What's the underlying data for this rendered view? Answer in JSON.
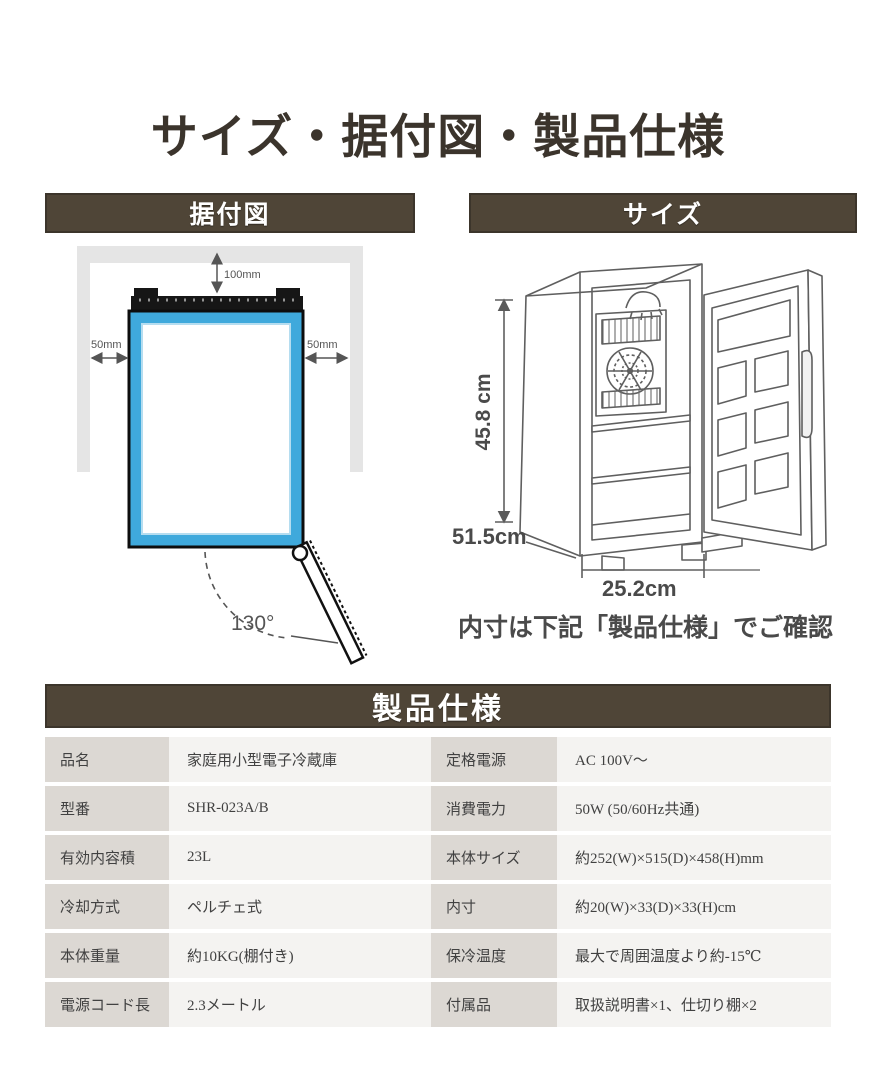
{
  "page": {
    "title": "サイズ・据付図・製品仕様"
  },
  "sections": {
    "installation": {
      "header": "据付図"
    },
    "size": {
      "header": "サイズ",
      "caption": "内寸は下記「製品仕様」でご確認"
    },
    "spec": {
      "header": "製品仕様"
    }
  },
  "installation_diagram": {
    "clearance_top": "100mm",
    "clearance_left": "50mm",
    "clearance_right": "50mm",
    "door_open_angle": "130°"
  },
  "size_diagram": {
    "height": "45.8 cm",
    "depth": "51.5cm",
    "width": "25.2cm"
  },
  "spec_table": {
    "rows": [
      {
        "label_left": "品名",
        "value_left": "家庭用小型電子冷蔵庫",
        "label_right": "定格電源",
        "value_right": "AC 100V～"
      },
      {
        "label_left": "型番",
        "value_left": "SHR-023A/B",
        "label_right": "消費電力",
        "value_right": "50W (50/60Hz共通)"
      },
      {
        "label_left": "有効内容積",
        "value_left": "23L",
        "label_right": "本体サイズ",
        "value_right": "約252(W)×515(D)×458(H)mm"
      },
      {
        "label_left": "冷却方式",
        "value_left": "ペルチェ式",
        "label_right": "内寸",
        "value_right": "約20(W)×33(D)×33(H)cm"
      },
      {
        "label_left": "本体重量",
        "value_left": "約10KG(棚付き)",
        "label_right": "保冷温度",
        "value_right": "最大で周囲温度より約-15℃"
      },
      {
        "label_left": "電源コード長",
        "value_left": "2.3メートル",
        "label_right": "付属品",
        "value_right": "取扱説明書×1、仕切り棚×2"
      }
    ]
  },
  "colors": {
    "header_bar": "#4f4537",
    "title_text": "#3b342c",
    "fridge_blue": "#3fa9dc",
    "wall_gray": "#e5e5e5",
    "label_cell_bg": "#dcd8d3",
    "value_cell_bg": "#f4f3f1"
  }
}
